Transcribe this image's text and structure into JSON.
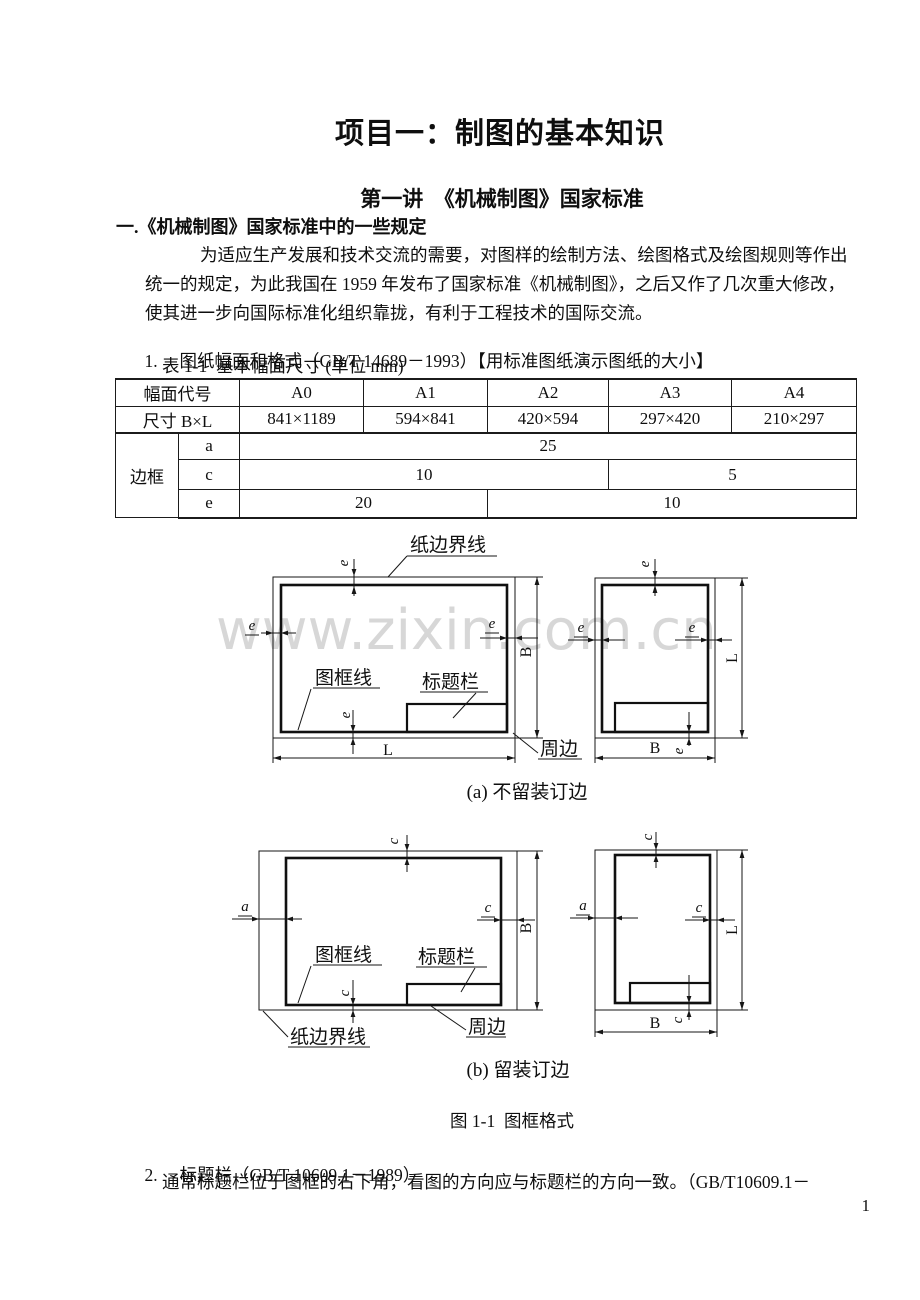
{
  "doc": {
    "title": "项目一：制图的基本知识",
    "lecture": "第一讲  《机械制图》国家标准",
    "section": "一.《机械制图》国家标准中的一些规定",
    "para_line1": "为适应生产发展和技术交流的需要，对图样的绘制方法、绘图格式及绘图规则等作出",
    "para_line2": "统一的规定，为此我国在 1959 年发布了国家标准《机械制图》，之后又作了几次重大修改，",
    "para_line3": "使其进一步向国际标准化组织靠拢，有利于工程技术的国际交流。",
    "item1_num": "1.",
    "item1_text": "图纸幅面和格式（GB/T 14689－1993）【用标准图纸演示图纸的大小】",
    "table_caption": "表 1-1  基本幅面尺寸 (单位 mm)",
    "figure_caption": "图 1-1  图框格式",
    "item2_num": "2.",
    "item2_text": "标题栏（GB/T 10609.1－1989）",
    "item2_body": "通常标题栏位于图框的右下角，看图的方向应与标题栏的方向一致。（GB/T10609.1－",
    "page_number": "1",
    "watermark": "www.zixin.com.cn"
  },
  "table": {
    "header": [
      "幅面代号",
      "A0",
      "A1",
      "A2",
      "A3",
      "A4"
    ],
    "size_label": "尺寸 B×L",
    "sizes": [
      "841×1189",
      "594×841",
      "420×594",
      "297×420",
      "210×297"
    ],
    "frame_label": "边框",
    "row_a_key": "a",
    "row_a_val": "25",
    "row_c_key": "c",
    "row_c_val1": "10",
    "row_c_val2": "5",
    "row_e_key": "e",
    "row_e_val1": "20",
    "row_e_val2": "10"
  },
  "figure": {
    "caption_a": "(a) 不留装订边",
    "caption_b": "(b) 留装订边",
    "labels": {
      "paper_edge": "纸边界线",
      "frame_line": "图框线",
      "title_block": "标题栏",
      "margin": "周边"
    },
    "dims": {
      "e": "e",
      "a": "a",
      "c": "c",
      "B": "B",
      "L": "L"
    }
  }
}
